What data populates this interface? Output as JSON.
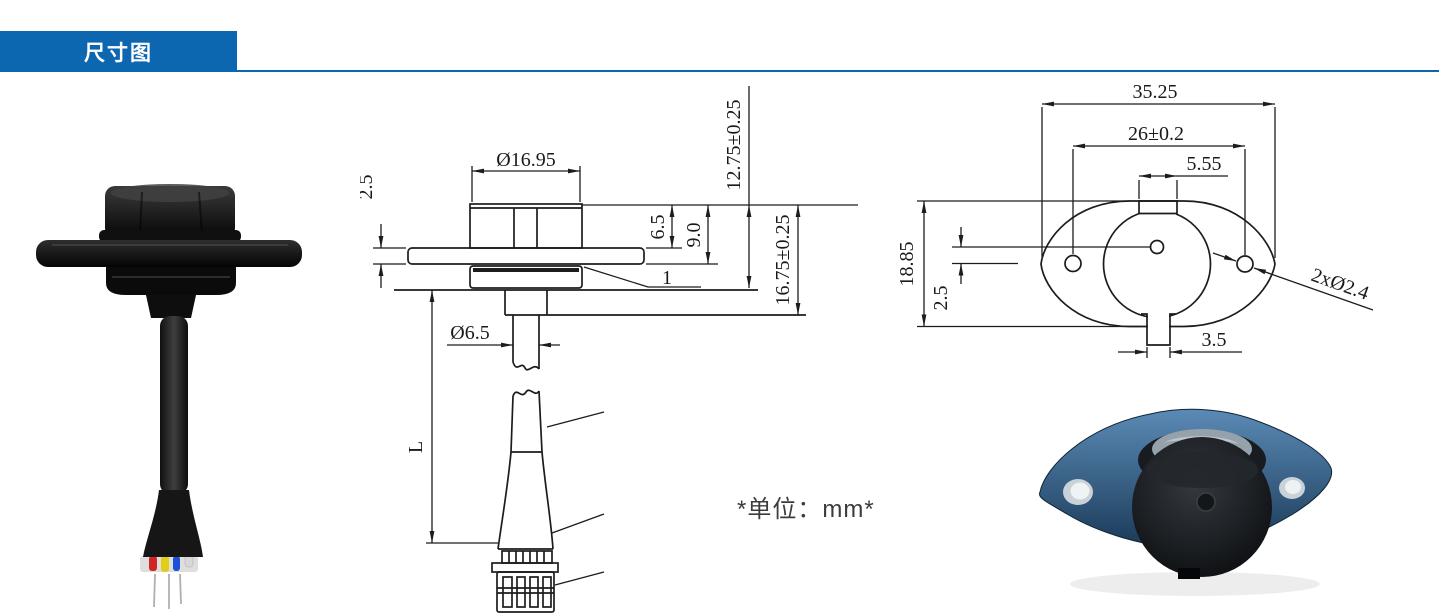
{
  "header": {
    "title": "尺寸图"
  },
  "note": {
    "unit": "*单位：mm*"
  },
  "side_view": {
    "dims": {
      "cap_diameter": "Ø16.95",
      "flange_thickness": "2.5",
      "cap_above_flange": "6.5",
      "head_height": "9.0",
      "height_to_mount": "12.75±0.25",
      "height_total": "16.75±0.25",
      "stem_diameter": "Ø6.5",
      "cable_length": "L",
      "gasket_item": "1"
    }
  },
  "top_view": {
    "dims": {
      "flange_width": "35.25",
      "hole_spacing": "26±0.2",
      "notch_width": "5.55",
      "flange_height": "18.85",
      "hole_offset": "2.5",
      "tab_width": "3.5",
      "mount_holes": "2xØ2.4"
    }
  },
  "colors": {
    "accent": "#0d67b0",
    "drawing_line": "#1c1c1c",
    "wire_red": "#d32424",
    "wire_yellow": "#e3ce17",
    "wire_blue": "#1e4fd6",
    "wire_white": "#d8d8d8",
    "flange_blue": "#2f5e8d"
  }
}
